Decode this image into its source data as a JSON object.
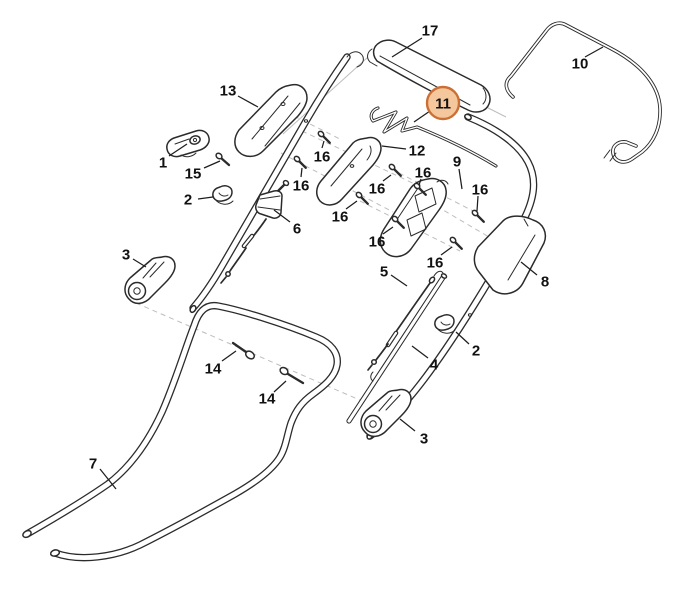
{
  "diagram": {
    "background": "#ffffff",
    "line_color": "#2b2b2b",
    "guide_color": "#bdbdbd",
    "label_color": "#111111",
    "highlighted_part": "11",
    "highlight": {
      "label": "11",
      "cx": 443,
      "cy": 103,
      "r": 16,
      "fill": "#f5c79d",
      "stroke": "#cc6f34",
      "leader": [
        [
          430,
          111
        ],
        [
          414,
          122
        ]
      ]
    },
    "callouts": [
      {
        "label": "17",
        "x": 430,
        "y": 30,
        "leader": [
          [
            422,
            38
          ],
          [
            392,
            57
          ]
        ]
      },
      {
        "label": "10",
        "x": 580,
        "y": 63,
        "leader": [
          [
            585,
            57
          ],
          [
            603,
            47
          ]
        ]
      },
      {
        "label": "13",
        "x": 228,
        "y": 90,
        "leader": [
          [
            238,
            96
          ],
          [
            258,
            107
          ]
        ]
      },
      {
        "label": "1",
        "x": 163,
        "y": 162,
        "leader": [
          [
            169,
            156
          ],
          [
            187,
            144
          ]
        ]
      },
      {
        "label": "15",
        "x": 193,
        "y": 173,
        "leader": [
          [
            204,
            168
          ],
          [
            220,
            161
          ]
        ]
      },
      {
        "label": "2",
        "x": 188,
        "y": 199,
        "leader": [
          [
            198,
            199
          ],
          [
            213,
            197
          ]
        ]
      },
      {
        "label": "6",
        "x": 297,
        "y": 228,
        "leader": [
          [
            290,
            222
          ],
          [
            274,
            210
          ]
        ]
      },
      {
        "label": "3",
        "x": 126,
        "y": 254,
        "leader": [
          [
            133,
            259
          ],
          [
            146,
            267
          ]
        ]
      },
      {
        "label": "12",
        "x": 417,
        "y": 150,
        "leader": [
          [
            406,
            149
          ],
          [
            382,
            146
          ]
        ]
      },
      {
        "label": "9",
        "x": 457,
        "y": 161,
        "leader": [
          [
            459,
            169
          ],
          [
            462,
            189
          ]
        ]
      },
      {
        "label": "16",
        "x": 322,
        "y": 156,
        "leader": [
          [
            322,
            148
          ],
          [
            324,
            141
          ]
        ]
      },
      {
        "label": "16",
        "x": 301,
        "y": 185,
        "leader": [
          [
            301,
            177
          ],
          [
            302,
            168
          ]
        ]
      },
      {
        "label": "16",
        "x": 340,
        "y": 216,
        "leader": [
          [
            346,
            209
          ],
          [
            357,
            201
          ]
        ]
      },
      {
        "label": "16",
        "x": 377,
        "y": 188,
        "leader": [
          [
            383,
            181
          ],
          [
            391,
            175
          ]
        ]
      },
      {
        "label": "16",
        "x": 423,
        "y": 172,
        "leader": [
          [
            421,
            179
          ],
          [
            419,
            185
          ]
        ]
      },
      {
        "label": "16",
        "x": 480,
        "y": 189,
        "leader": [
          [
            478,
            196
          ],
          [
            477,
            211
          ]
        ]
      },
      {
        "label": "16",
        "x": 435,
        "y": 262,
        "leader": [
          [
            441,
            255
          ],
          [
            452,
            247
          ]
        ]
      },
      {
        "label": "16",
        "x": 377,
        "y": 241,
        "leader": [
          [
            383,
            234
          ],
          [
            393,
            227
          ]
        ]
      },
      {
        "label": "8",
        "x": 545,
        "y": 281,
        "leader": [
          [
            537,
            275
          ],
          [
            521,
            262
          ]
        ]
      },
      {
        "label": "5",
        "x": 384,
        "y": 271,
        "leader": [
          [
            391,
            275
          ],
          [
            407,
            286
          ]
        ]
      },
      {
        "label": "4",
        "x": 434,
        "y": 364,
        "leader": [
          [
            428,
            358
          ],
          [
            412,
            346
          ]
        ]
      },
      {
        "label": "2",
        "x": 476,
        "y": 350,
        "leader": [
          [
            469,
            344
          ],
          [
            456,
            332
          ]
        ]
      },
      {
        "label": "3",
        "x": 424,
        "y": 438,
        "leader": [
          [
            415,
            431
          ],
          [
            400,
            419
          ]
        ]
      },
      {
        "label": "7",
        "x": 93,
        "y": 463,
        "leader": [
          [
            100,
            469
          ],
          [
            116,
            489
          ]
        ]
      },
      {
        "label": "14",
        "x": 213,
        "y": 368,
        "leader": [
          [
            222,
            361
          ],
          [
            236,
            351
          ]
        ]
      },
      {
        "label": "14",
        "x": 267,
        "y": 398,
        "leader": [
          [
            274,
            392
          ],
          [
            286,
            381
          ]
        ]
      }
    ]
  }
}
